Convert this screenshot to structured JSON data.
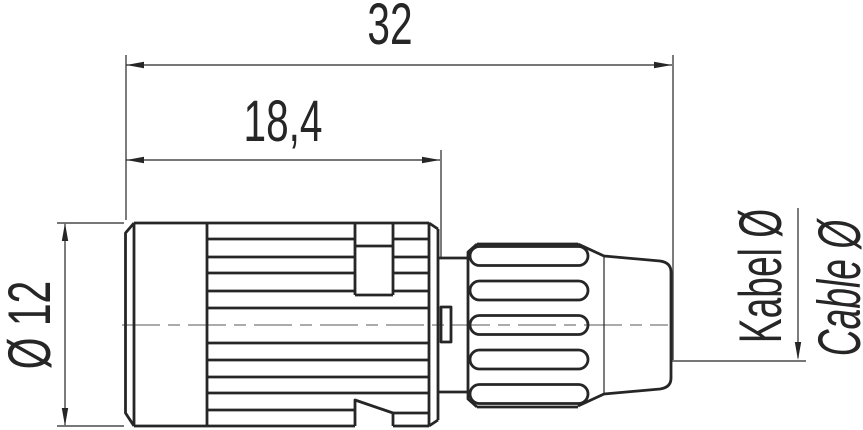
{
  "drawing": {
    "type": "connector-side-view-technical-drawing",
    "dimensions": {
      "total_length": "32",
      "front_length": "18,4",
      "body_diameter": "Ø 12"
    },
    "labels": {
      "cable_diameter_de": "Kabel Ø",
      "cable_diameter_en": "Cable Ø"
    }
  },
  "colors": {
    "line": "#262626",
    "centerline": "#8f8f8f",
    "background": "#ffffff"
  }
}
